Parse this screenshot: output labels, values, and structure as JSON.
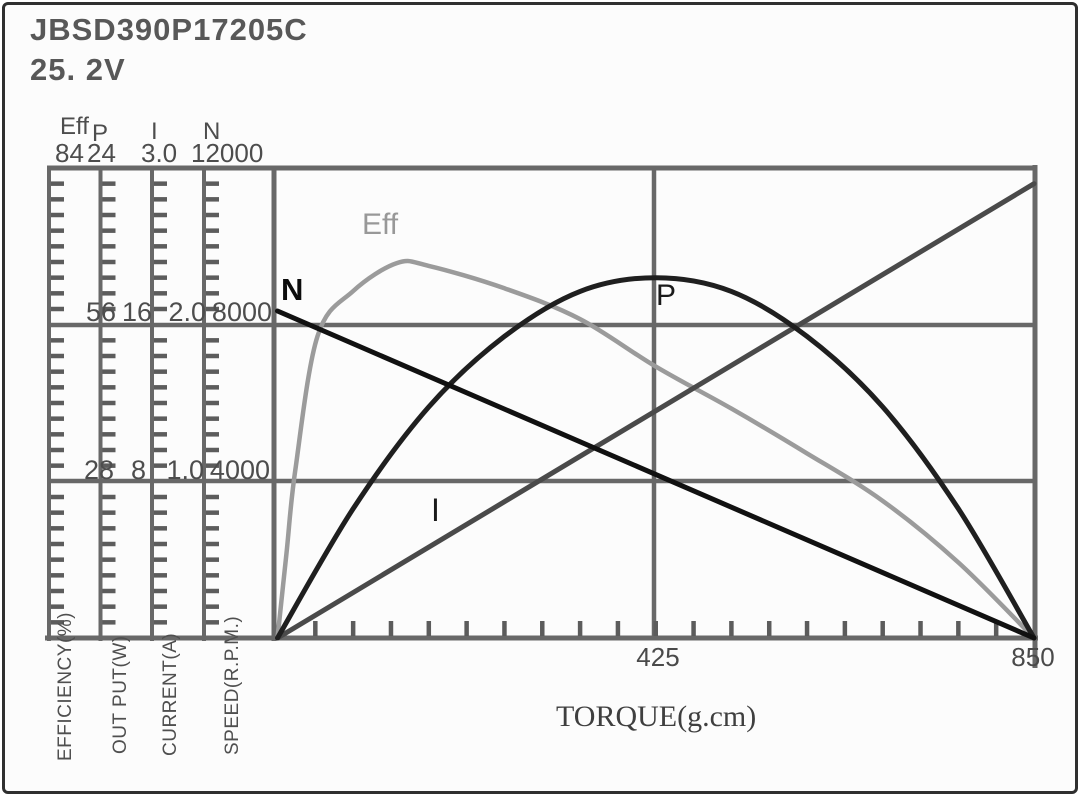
{
  "header": {
    "model": "JBSD390P17205C",
    "voltage": "25. 2V"
  },
  "axis_headers": [
    {
      "name": "Eff",
      "value": "84"
    },
    {
      "name": "P",
      "value": "24"
    },
    {
      "name": "I",
      "value": "3.0"
    },
    {
      "name": "N",
      "value": "12000"
    }
  ],
  "tick_rows": {
    "mid": [
      "56",
      "16",
      "2.0",
      "8000"
    ],
    "low": [
      "28",
      "8",
      "1.0",
      "4000"
    ]
  },
  "axis_units": [
    "EFFICIENCY(%)",
    "OUT PUT(W)",
    "CURRENT(A)",
    "SPEED(R.P.M.)"
  ],
  "x_axis": {
    "label": "TORQUE(g.cm)",
    "mid": "425",
    "max": "850"
  },
  "curve_labels": {
    "eff": "Eff",
    "n": "N",
    "p": "P",
    "i": "I"
  },
  "colors": {
    "grid": "#686868",
    "tick": "#5c5c5c",
    "text": "#4a4a4a",
    "curve_n": "#111111",
    "curve_p": "#1f1f1f",
    "curve_i": "#4a4a4a",
    "curve_eff": "#9b9b9b"
  },
  "chart_data": {
    "type": "line",
    "title": "JBSD390P17205C 25.2V motor performance curves",
    "xlabel": "TORQUE(g.cm)",
    "x_range": [
      0,
      850
    ],
    "x_ticks": [
      425,
      850
    ],
    "x_minor_tick_step": 42.5,
    "grid": "on",
    "y_axes": [
      {
        "id": "eff",
        "label": "EFFICIENCY(%)",
        "range": [
          0,
          84
        ],
        "ticks": [
          28,
          56,
          84
        ]
      },
      {
        "id": "p",
        "label": "OUT PUT(W)",
        "range": [
          0,
          24
        ],
        "ticks": [
          8,
          16,
          24
        ]
      },
      {
        "id": "i",
        "label": "CURRENT(A)",
        "range": [
          0,
          3.0
        ],
        "ticks": [
          1.0,
          2.0,
          3.0
        ]
      },
      {
        "id": "n",
        "label": "SPEED(R.P.M.)",
        "range": [
          0,
          12000
        ],
        "ticks": [
          4000,
          8000,
          12000
        ]
      }
    ],
    "series": [
      {
        "name": "Eff",
        "axis": "eff",
        "style": "smooth",
        "color": "#9b9b9b",
        "x": [
          0,
          10,
          20,
          45,
          85,
          134,
          170,
          255,
          340,
          425,
          510,
          595,
          680,
          765,
          850
        ],
        "values": [
          0,
          15,
          30,
          54,
          62,
          67,
          66.5,
          62.5,
          57,
          48.5,
          41,
          33,
          24.5,
          13.5,
          0
        ]
      },
      {
        "name": "I",
        "axis": "i",
        "style": "straight",
        "color": "#4a4a4a",
        "x": [
          0,
          850
        ],
        "values": [
          0,
          2.9
        ]
      },
      {
        "name": "P",
        "axis": "p",
        "style": "smooth",
        "color": "#1f1f1f",
        "x": [
          0,
          85,
          170,
          255,
          340,
          425,
          510,
          595,
          680,
          765,
          850
        ],
        "values": [
          0,
          6.6,
          11.8,
          15.4,
          17.7,
          18.4,
          17.7,
          15.4,
          11.8,
          6.6,
          0
        ]
      },
      {
        "name": "N",
        "axis": "n",
        "style": "straight",
        "color": "#111111",
        "x": [
          0,
          850
        ],
        "values": [
          8350,
          0
        ]
      }
    ]
  }
}
